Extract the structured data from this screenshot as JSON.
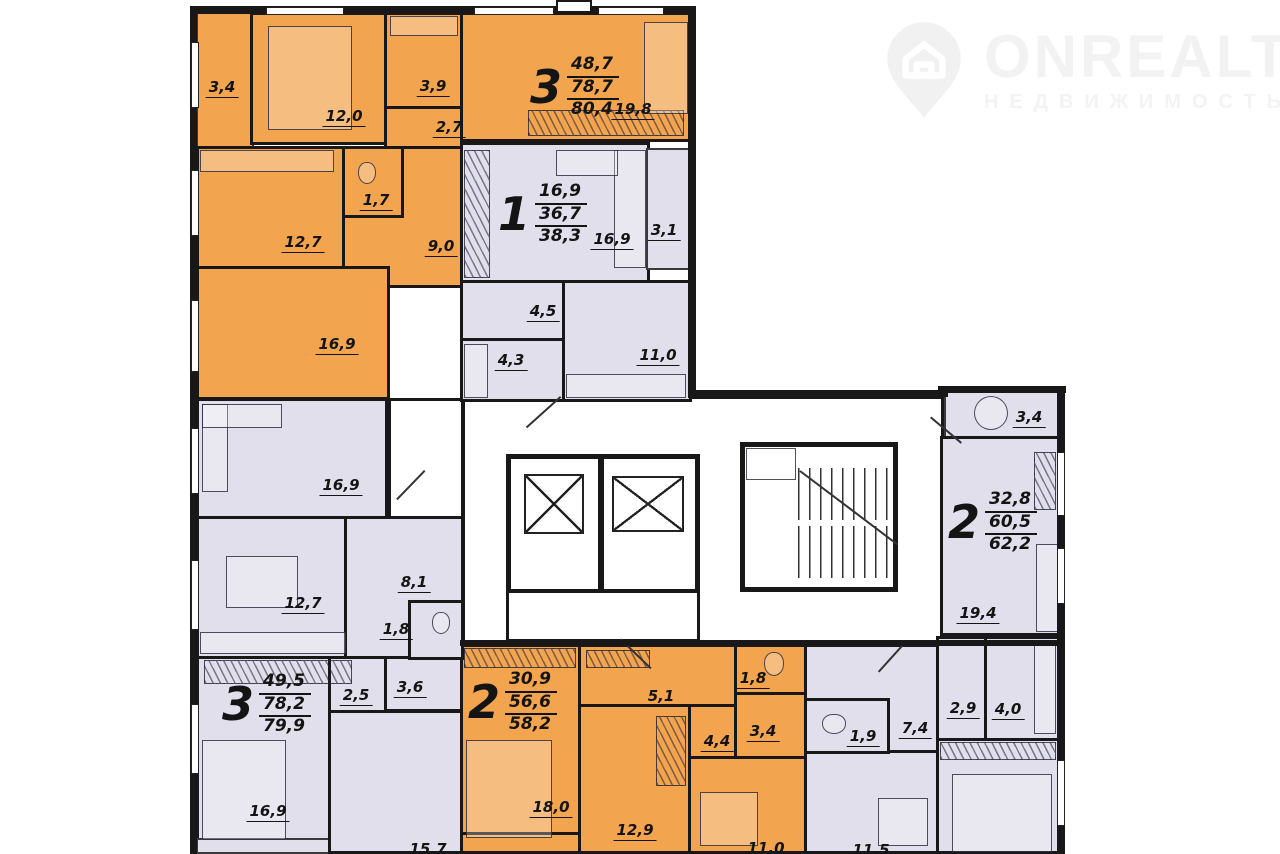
{
  "logo": {
    "brand": "ONREALT",
    "tagline": "НЕДВИЖИМОСТЬ"
  },
  "colors": {
    "apartment_orange": "#F2A44F",
    "apartment_lilac": "#E1DFEB",
    "wall": "#181818",
    "background": "#FFFFFF",
    "logo": "#F2F2F2"
  },
  "apartments": [
    {
      "number": "3",
      "living": "48,7",
      "area": "78,7",
      "total": "80,4"
    },
    {
      "number": "1",
      "living": "16,9",
      "area": "36,7",
      "total": "38,3"
    },
    {
      "number": "2",
      "living": "32,8",
      "area": "60,5",
      "total": "62,2"
    },
    {
      "number": "3",
      "living": "49,5",
      "area": "78,2",
      "total": "79,9"
    },
    {
      "number": "2",
      "living": "30,9",
      "area": "56,6",
      "total": "58,2"
    }
  ],
  "rooms": [
    {
      "name": "balcony",
      "area": "3,4"
    },
    {
      "name": "bedroom",
      "area": "12,0"
    },
    {
      "name": "bathroom",
      "area": "3,9"
    },
    {
      "name": "corridor",
      "area": "2,7"
    },
    {
      "name": "living-room",
      "area": "19,8"
    },
    {
      "name": "kitchen",
      "area": "12,7"
    },
    {
      "name": "wc",
      "area": "1,7"
    },
    {
      "name": "hallway",
      "area": "9,0"
    },
    {
      "name": "living-room",
      "area": "16,9"
    },
    {
      "name": "living-room",
      "area": "16,9"
    },
    {
      "name": "balcony",
      "area": "3,1"
    },
    {
      "name": "hallway",
      "area": "4,5"
    },
    {
      "name": "bathroom",
      "area": "4,3"
    },
    {
      "name": "kitchen",
      "area": "11,0"
    },
    {
      "name": "living-room",
      "area": "16,9"
    },
    {
      "name": "kitchen",
      "area": "12,7"
    },
    {
      "name": "hallway",
      "area": "8,1"
    },
    {
      "name": "wc",
      "area": "1,8"
    },
    {
      "name": "hallway",
      "area": "2,5"
    },
    {
      "name": "bathroom",
      "area": "3,6"
    },
    {
      "name": "bedroom",
      "area": "16,9"
    },
    {
      "name": "room",
      "area": "15,7"
    },
    {
      "name": "bedroom",
      "area": "18,0"
    },
    {
      "name": "corridor",
      "area": "5,1"
    },
    {
      "name": "wc",
      "area": "1,8"
    },
    {
      "name": "hallway",
      "area": "4,4"
    },
    {
      "name": "bathroom",
      "area": "3,4"
    },
    {
      "name": "room",
      "area": "12,9"
    },
    {
      "name": "kitchen",
      "area": "11,0"
    },
    {
      "name": "wc",
      "area": "1,9"
    },
    {
      "name": "hallway",
      "area": "7,4"
    },
    {
      "name": "hallway",
      "area": "2,9"
    },
    {
      "name": "bathroom",
      "area": "4,0"
    },
    {
      "name": "kitchen",
      "area": "11,5"
    },
    {
      "name": "balcony",
      "area": "3,4"
    },
    {
      "name": "living-room",
      "area": "19,4"
    }
  ]
}
